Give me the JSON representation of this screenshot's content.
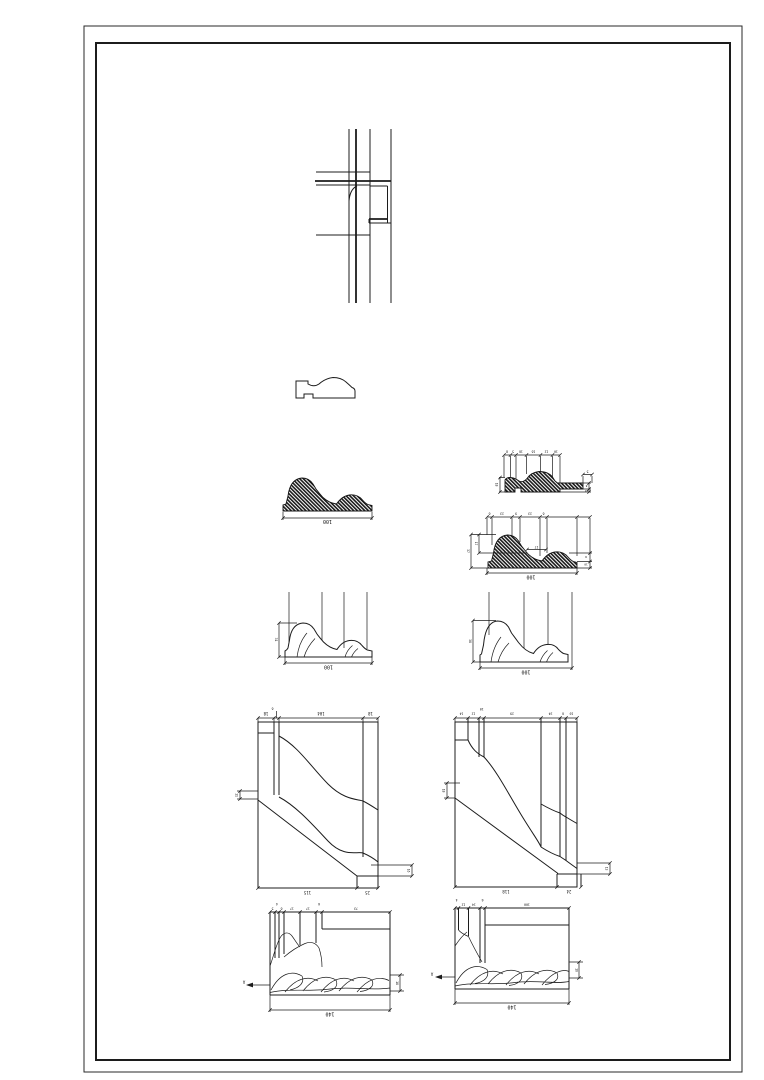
{
  "sheet": {
    "background": "#ffffff",
    "line_color": "#1c1c1c"
  },
  "drawings": {
    "wall_plan_detail": {},
    "profile_outline_small": {},
    "profile_section_a": {
      "width": "100"
    },
    "profile_section_b": {
      "top_dims": [
        "8",
        "5",
        "16",
        "16",
        "12",
        "10"
      ],
      "left_dim": "18",
      "right_top_dim": "5",
      "right_dims": [
        "8",
        "10"
      ]
    },
    "profile_section_c": {
      "top_dims": [
        "6",
        "23",
        "9",
        "23",
        "6"
      ],
      "left_outer_dim": "37",
      "left_inner_dim": "17",
      "middle_dim": "17",
      "right_dims": [
        "8",
        "10"
      ],
      "width": "100"
    },
    "profile_elevation_left": {
      "height": "31",
      "width": "100"
    },
    "profile_elevation_right": {
      "height": "38",
      "width": "100"
    },
    "cornice_detail_left": {
      "top_dims": [
        "18",
        "104",
        "18"
      ],
      "top_small_dim": "6",
      "left_dim": "11",
      "right_dim": "16",
      "bottom_dims": [
        "115",
        "25"
      ]
    },
    "cornice_detail_right": {
      "top_dims": [
        "14",
        "12",
        "10",
        "29",
        "24",
        "6",
        "10"
      ],
      "left_dim": "18",
      "right_dim": "13",
      "bottom_dims": [
        "118",
        "24"
      ]
    },
    "plan_detail_left": {
      "top_dims": [
        "5",
        "4",
        "6",
        "17",
        "17",
        "6",
        "73"
      ],
      "right_dim": "18",
      "width": "140",
      "section_marker": "A"
    },
    "plan_detail_right": {
      "top_dims": [
        "4",
        "12",
        "14",
        "6",
        "100"
      ],
      "right_dim": "16",
      "width": "140",
      "section_marker": "A"
    }
  }
}
